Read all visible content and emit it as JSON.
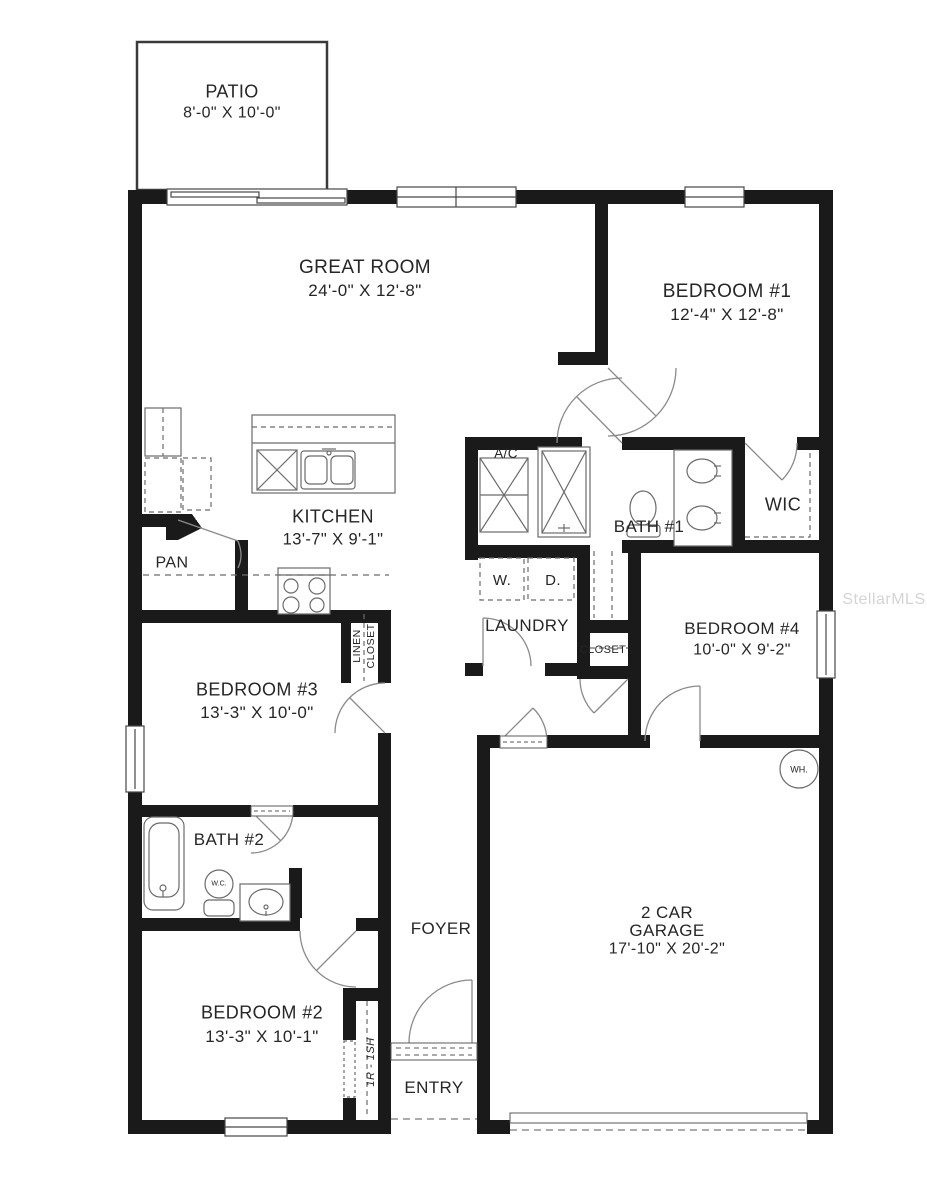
{
  "watermark": "StellarMLS",
  "rooms": {
    "patio": {
      "name": "PATIO",
      "dims": "8'-0\" X 10'-0\""
    },
    "great_room": {
      "name": "GREAT ROOM",
      "dims": "24'-0\" X 12'-8\""
    },
    "bedroom1": {
      "name": "BEDROOM #1",
      "dims": "12'-4\" X 12'-8\""
    },
    "kitchen": {
      "name": "KITCHEN",
      "dims": "13'-7\" X 9'-1\""
    },
    "pantry": {
      "name": "PAN"
    },
    "ac_closet": {
      "name": "A/C"
    },
    "bath1": {
      "name": "BATH #1"
    },
    "wic": {
      "name": "WIC"
    },
    "washer": {
      "name": "W."
    },
    "dryer": {
      "name": "D."
    },
    "laundry": {
      "name": "LAUNDRY"
    },
    "bedroom4": {
      "name": "BEDROOM #4",
      "dims": "10'-0\" X 9'-2\""
    },
    "hall_closet": {
      "name": "CLOSET"
    },
    "linen_closet": {
      "line1": "LINEN",
      "line2": "CLOSET"
    },
    "bedroom3": {
      "name": "BEDROOM #3",
      "dims": "13'-3\" X 10'-0\""
    },
    "bath2": {
      "name": "BATH #2"
    },
    "water_closet": {
      "name": "W.C."
    },
    "foyer": {
      "name": "FOYER"
    },
    "bedroom2": {
      "name": "BEDROOM #2",
      "dims": "13'-3\" X 10'-1\""
    },
    "entry_closet": {
      "name": "1R - 1SH"
    },
    "entry": {
      "name": "ENTRY"
    },
    "garage": {
      "line1": "2 CAR",
      "line2": "GARAGE",
      "dims": "17'-10\" X 20'-2\""
    },
    "water_heater": {
      "name": "WH."
    }
  },
  "colors": {
    "wall": "#1a1a1a",
    "line": "#6b6b6b",
    "watermark": "#d4d4d4"
  }
}
